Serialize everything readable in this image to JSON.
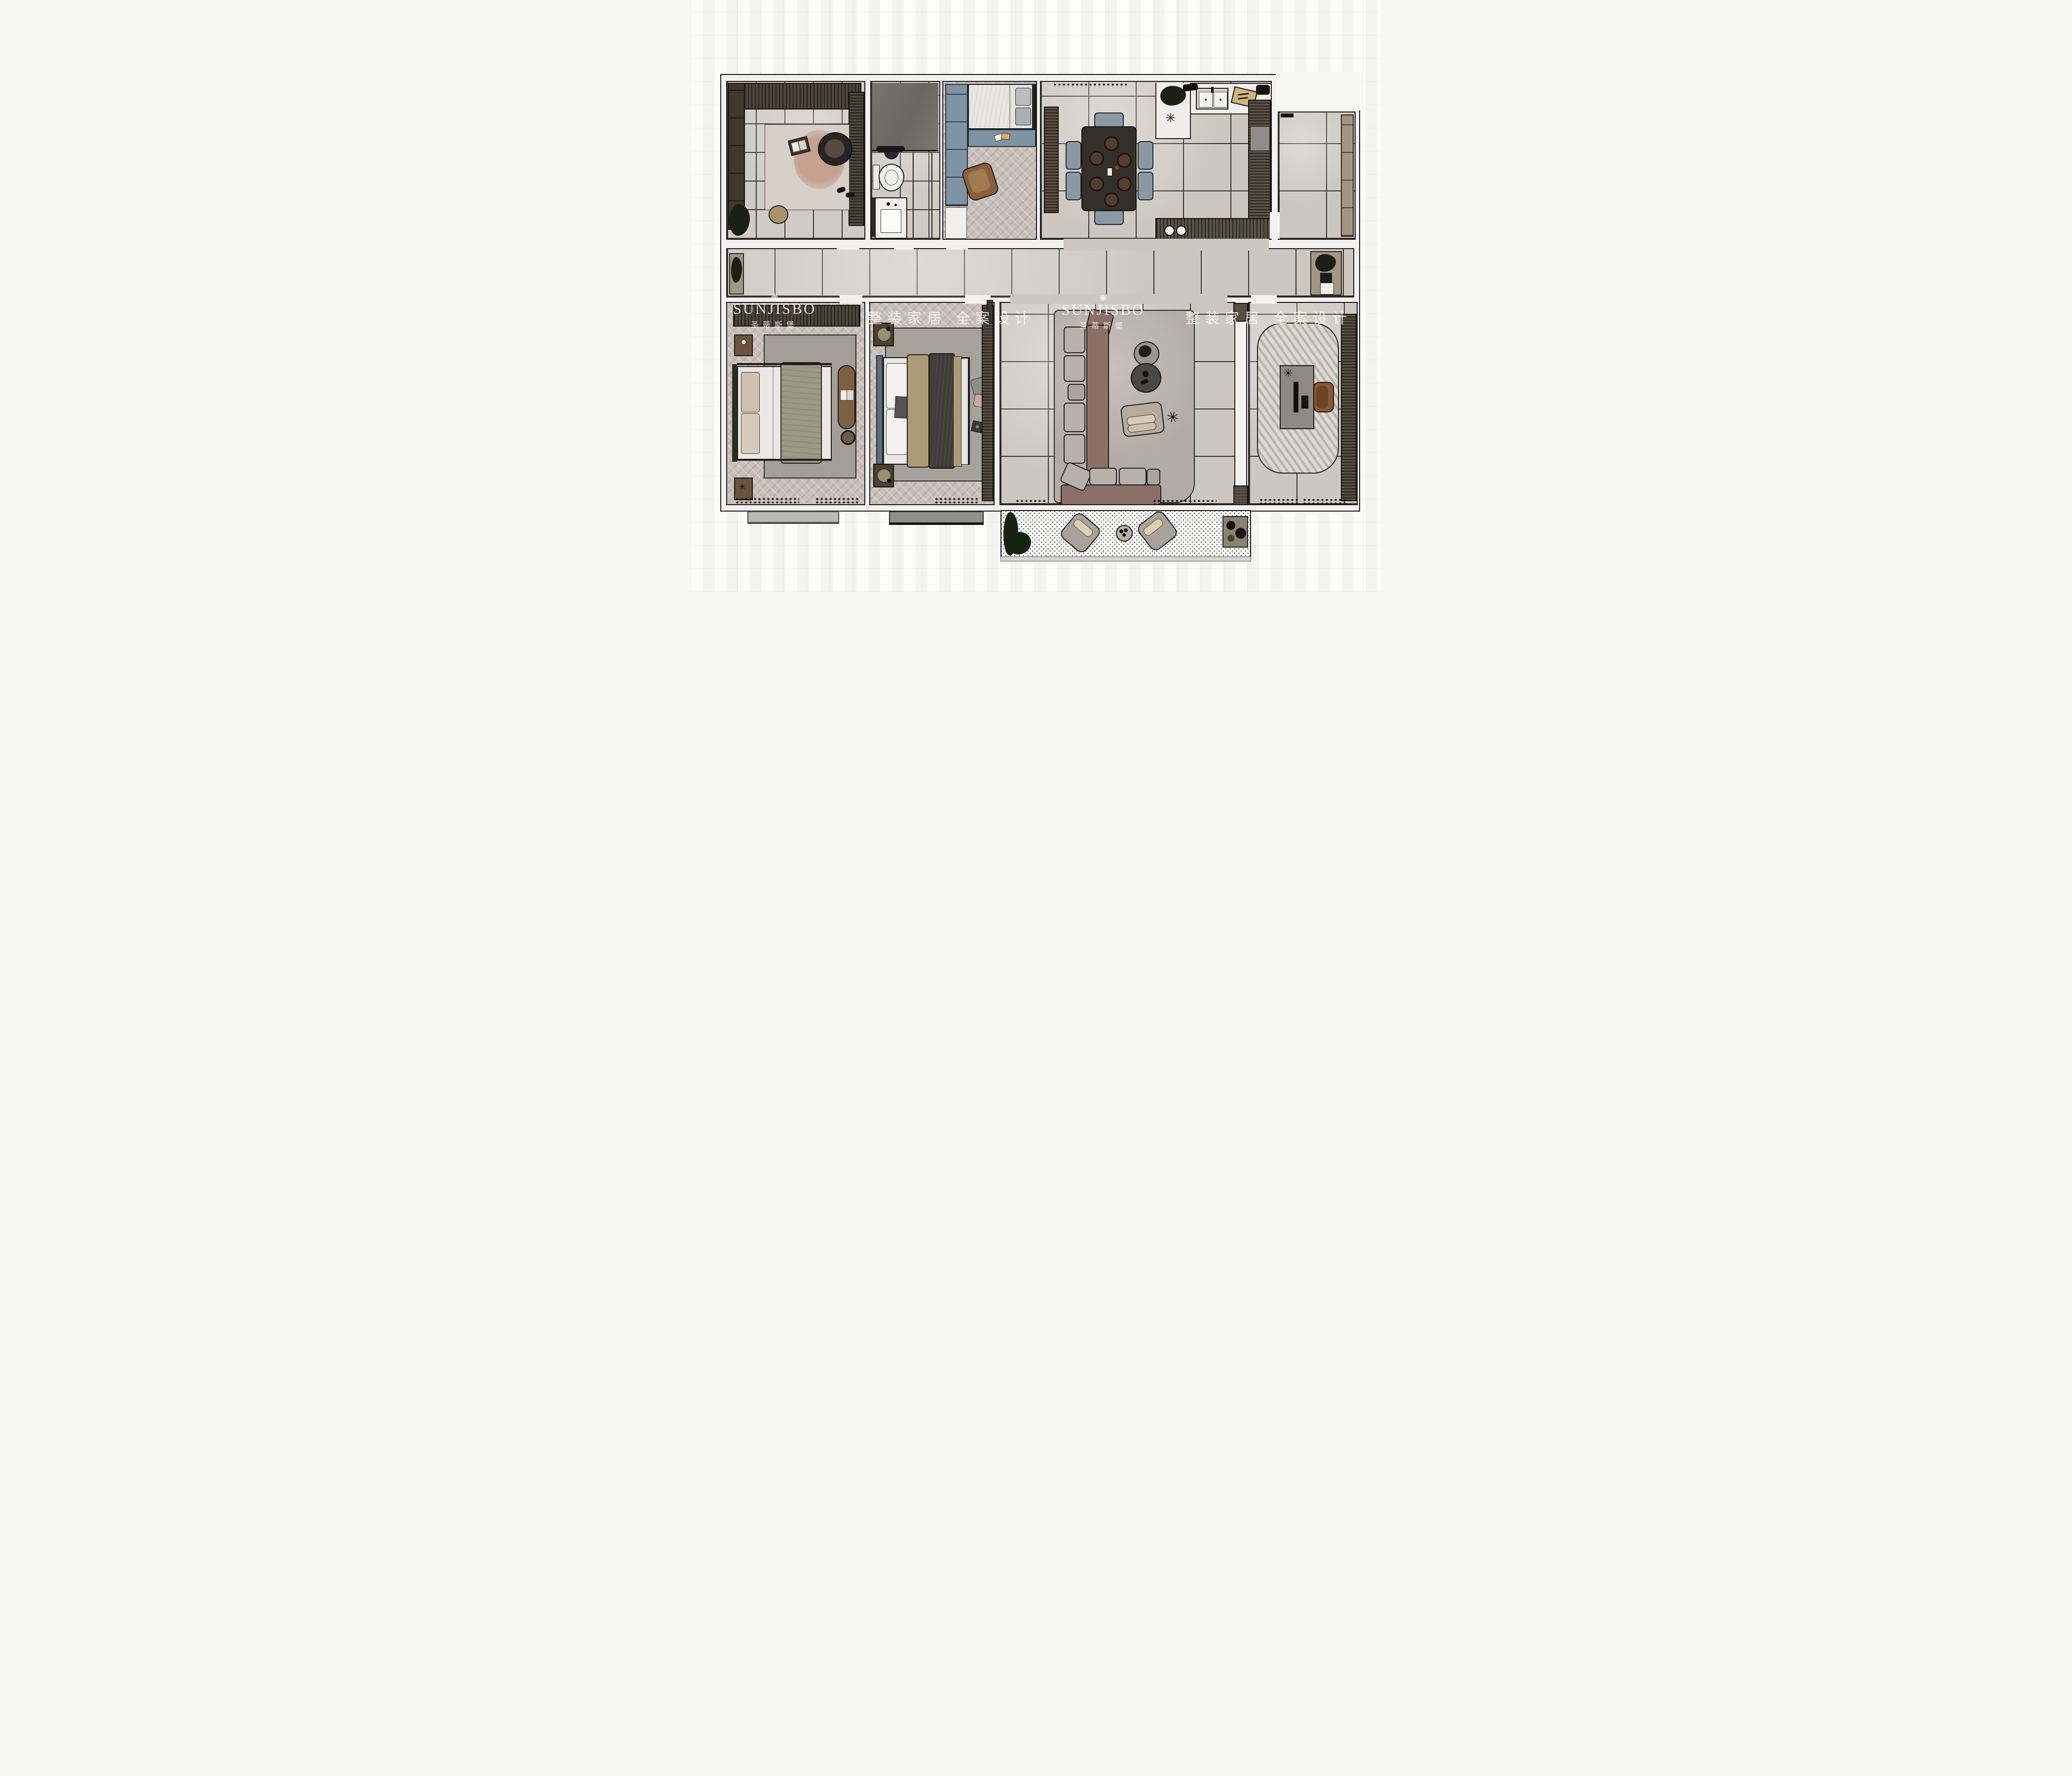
{
  "watermarks": {
    "brand_latin": "SUNJISBO",
    "brand_cn": "圣蒂斯堡",
    "slogan": "整装家居 全案设计"
  },
  "icons": {
    "flower": "❋",
    "sparkle": "✳"
  },
  "palette": {
    "page_bg": "#f6f6f5",
    "wall": "#f2f1ef",
    "outline": "#1c1c1c",
    "tile_floor": "#ccc8c1",
    "grout": "#35322e",
    "herringbone_floor": "#c9bfba",
    "cabinet_dark": "#4e463c",
    "cabinet_blue": "#7e93a3",
    "sofa_body": "#8c7068",
    "sofa_cushion": "#b7b1a9",
    "dining_table": "#343029",
    "dining_chair": "#8a99a3",
    "wood_brown": "#7d5f46",
    "rug_gray": "#a7a19b",
    "olive_blanket": "#9a9a85",
    "charcoal_duvet": "#3e3c39",
    "tan_blanket": "#ad9a77",
    "plant_dark": "#1b1f14",
    "balcony_floor_dots": "#4a4a4a",
    "watermark_text": "rgba(255,255,255,0.82)"
  },
  "rooms": [
    {
      "id": "cloakroom-lounge"
    },
    {
      "id": "bathroom"
    },
    {
      "id": "small-bedroom"
    },
    {
      "id": "dining-kitchen"
    },
    {
      "id": "right-balcony"
    },
    {
      "id": "hallway"
    },
    {
      "id": "master-bedroom"
    },
    {
      "id": "second-bedroom"
    },
    {
      "id": "living-room"
    },
    {
      "id": "study"
    },
    {
      "id": "bottom-balcony"
    }
  ]
}
